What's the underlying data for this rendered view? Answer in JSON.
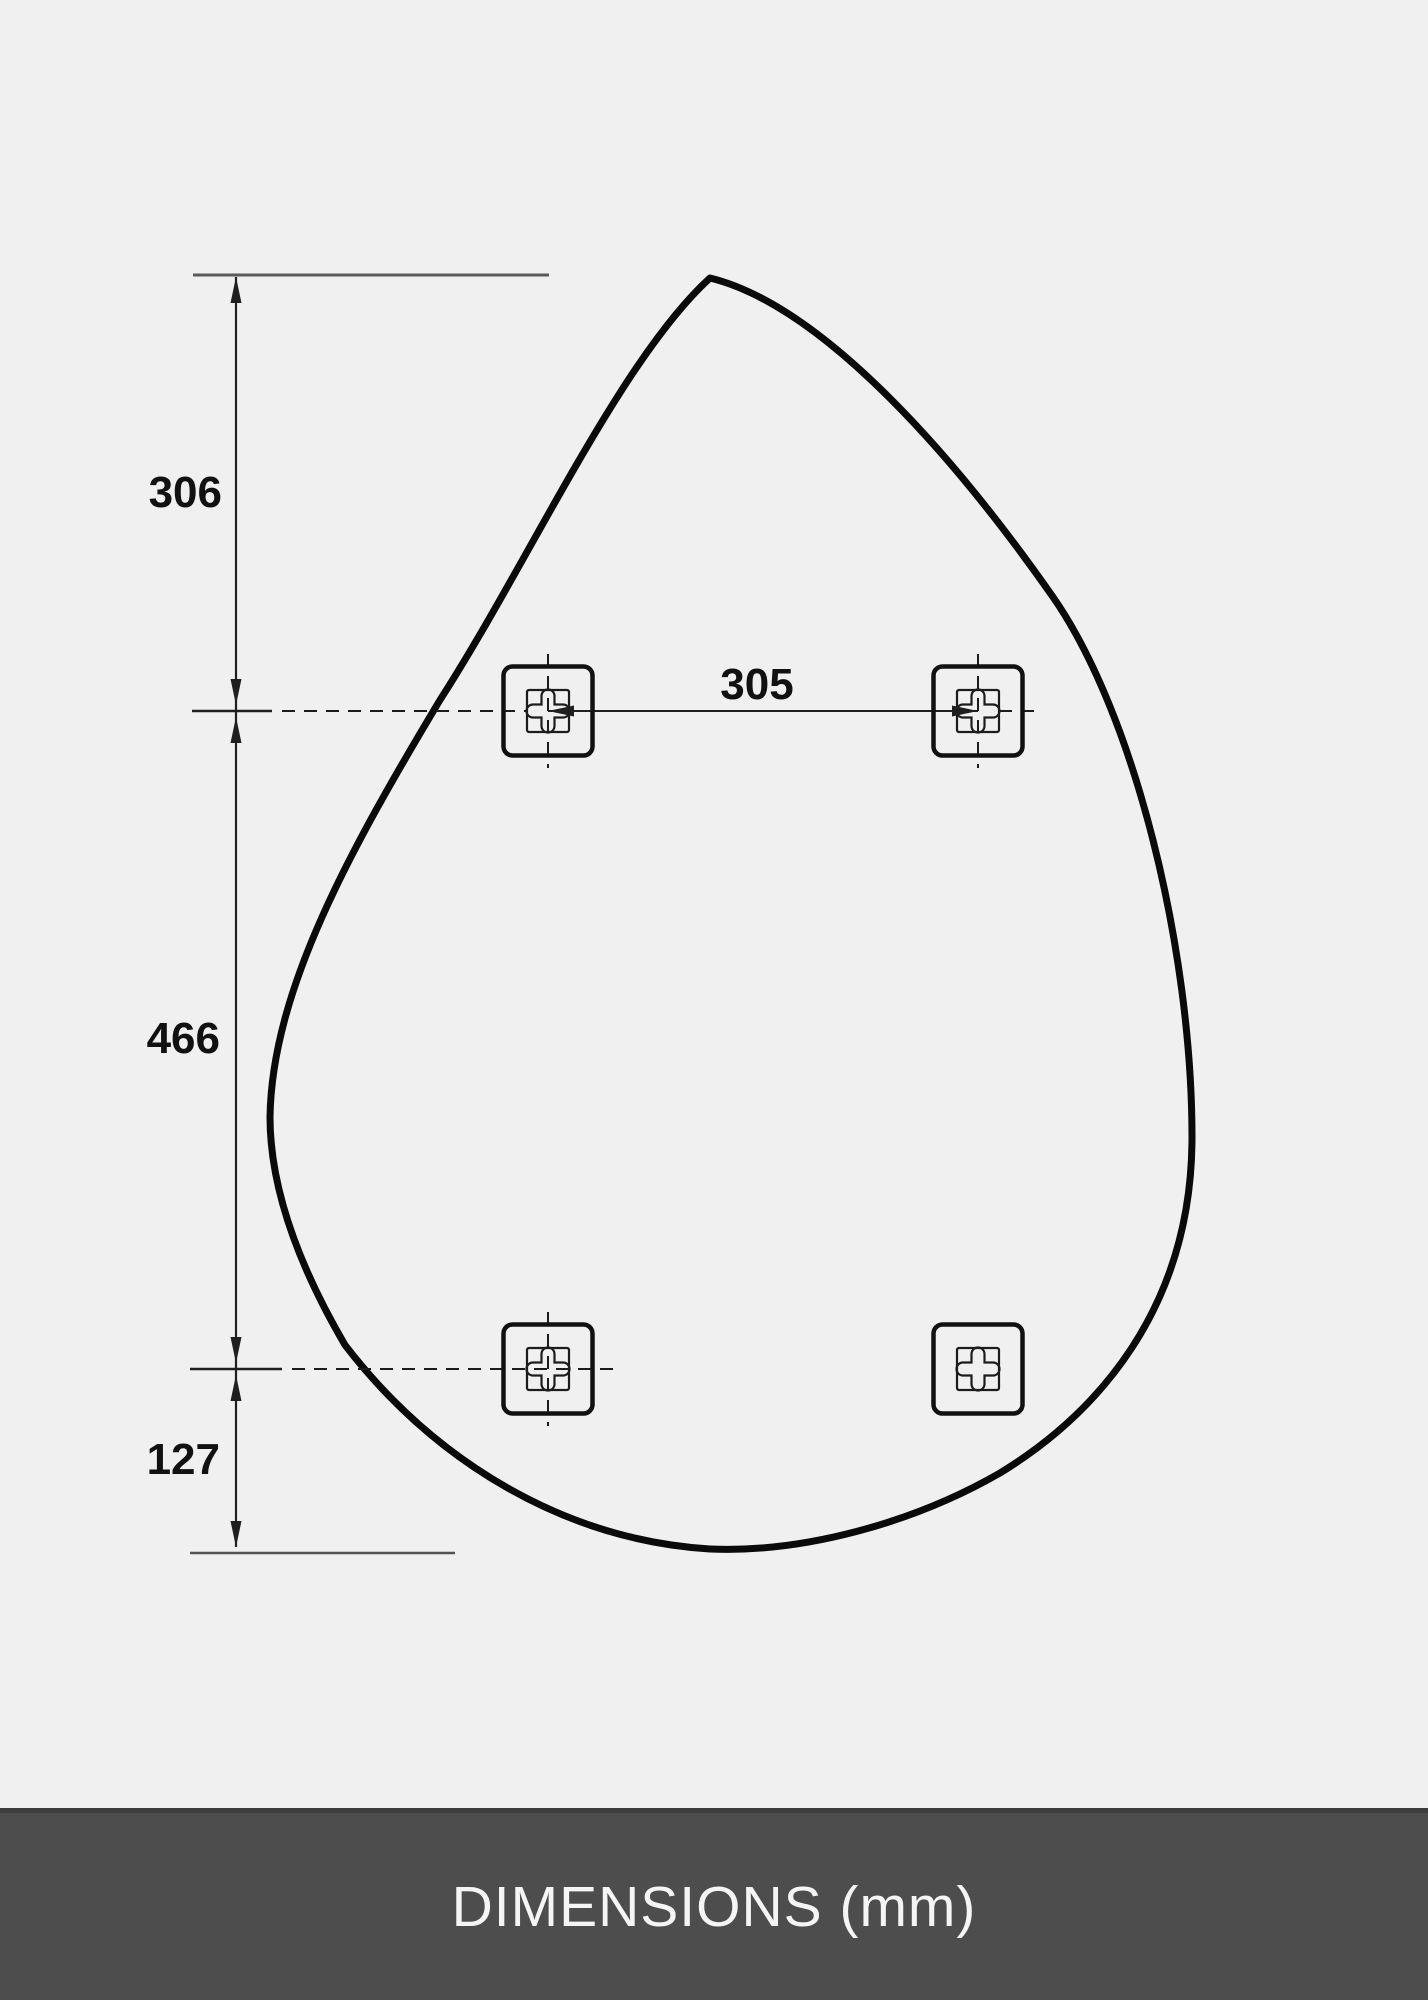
{
  "diagram": {
    "name": "teardrop-mirror-mounting-dimensions",
    "unit": "mm",
    "dimension_labels": {
      "top_offset": "306",
      "middle_span": "466",
      "bottom_offset": "127",
      "bracket_spacing": "305"
    },
    "brackets": [
      {
        "position": "top-left",
        "icon": "keyhole-cross-icon",
        "crosshair": true,
        "arrow": true
      },
      {
        "position": "top-right",
        "icon": "keyhole-cross-icon",
        "crosshair": true,
        "arrow": true
      },
      {
        "position": "bottom-left",
        "icon": "keyhole-cross-icon",
        "crosshair": true,
        "arrow": false
      },
      {
        "position": "bottom-right",
        "icon": "keyhole-cross-icon",
        "crosshair": false,
        "arrow": false
      }
    ]
  },
  "footer": {
    "label": "DIMENSIONS (mm)"
  },
  "colors": {
    "background": "#f0f0f0",
    "outline": "#0a0a0a",
    "dimension_line": "#1f1f1f",
    "extension_line": "#5a5a5a",
    "footer_background": "#4d4d4d",
    "footer_text": "#f5f5f5"
  }
}
